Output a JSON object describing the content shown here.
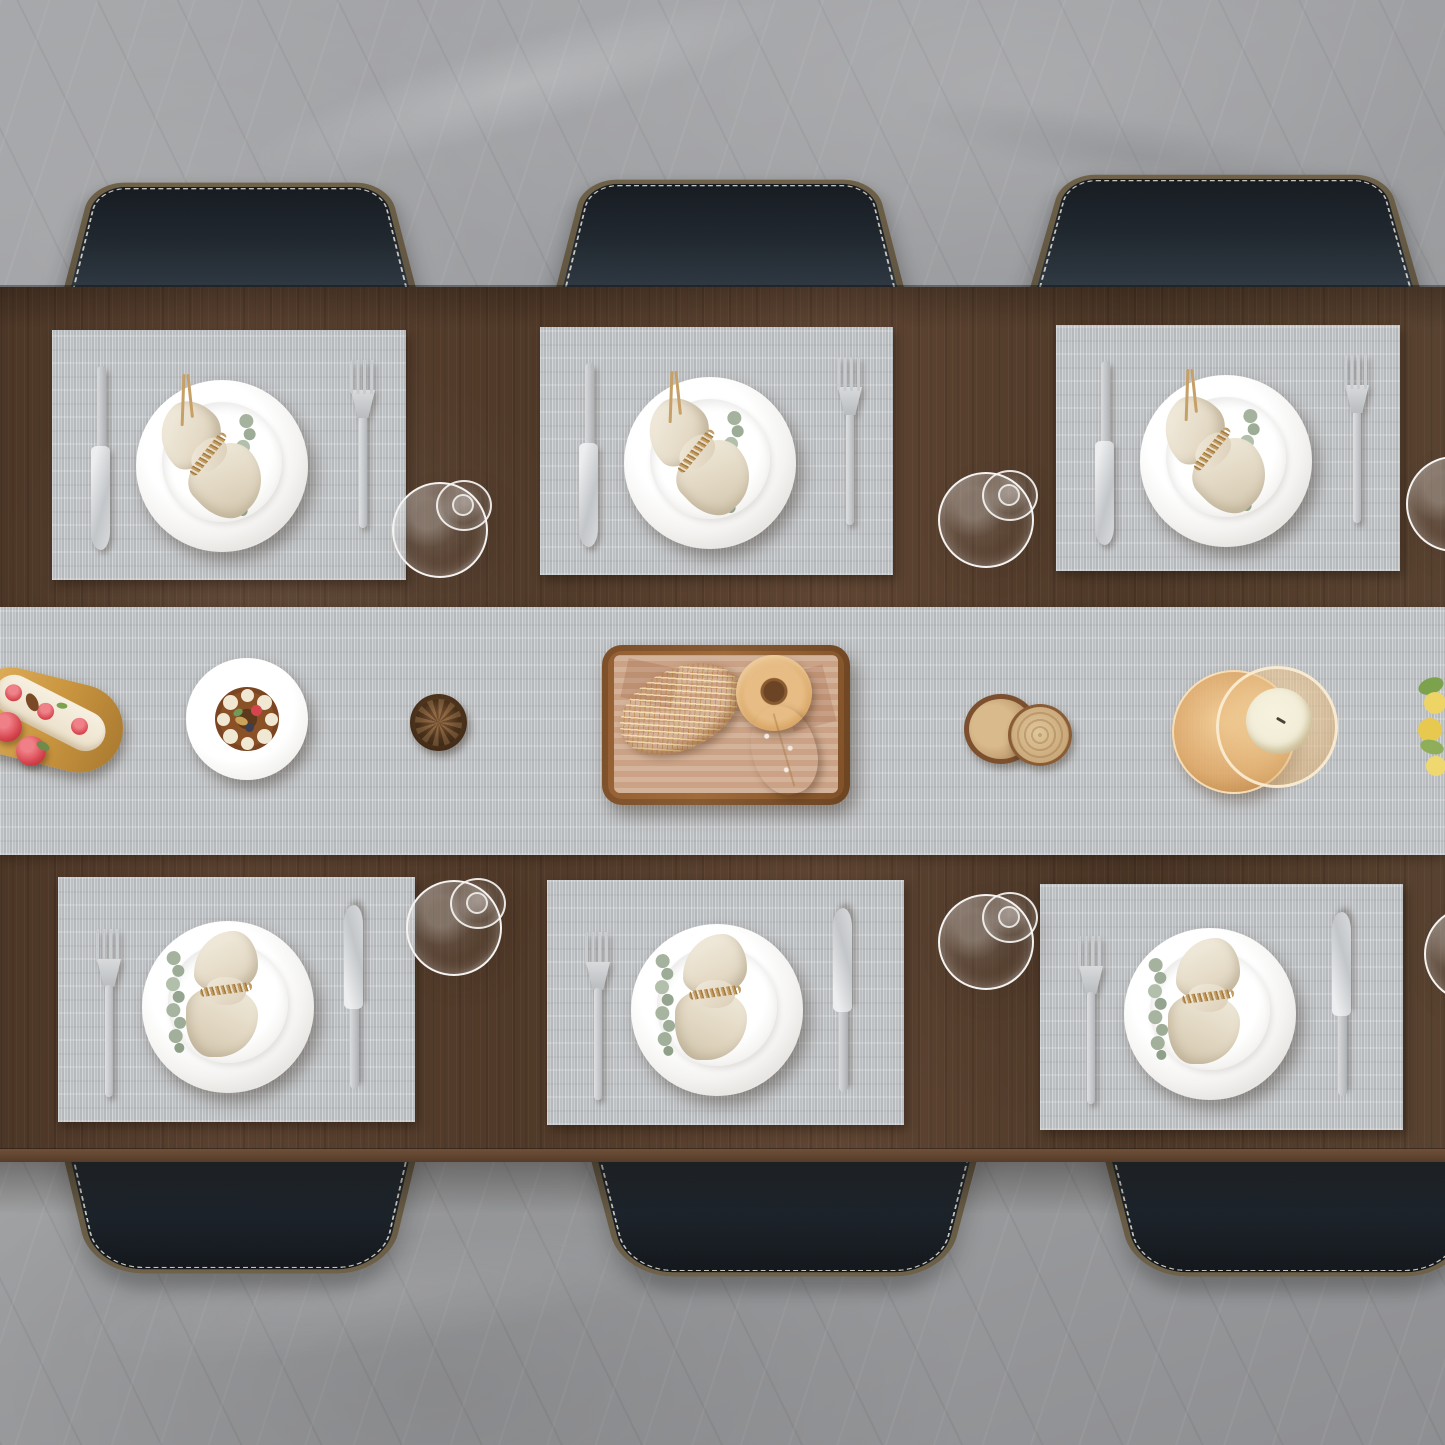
{
  "scene": {
    "type": "product-photo",
    "view": "top-down",
    "description": "Overhead view of a dark walnut dining table set for six on a gray marble floor. Six woven gray placemats and a matching table runner hold white plates with cream napkins tied in twine and eucalyptus sprigs, flanked by silver knives and forks, with six wine glasses lying beside the mats. The runner is decorated with a strawberry eclair on a wooden board, a chocolate dessert plate, a pine cone, a wooden bread tray with sesame bread, a donut and a sugared bun, wood-slice decor, a candle in an amber glass holder and yellow flowers. Six black leather chairs with white zigzag stitching surround the table.",
    "place_settings": 6,
    "chairs_visible": 6,
    "wine_glasses": 6
  },
  "items": {
    "table": "Walnut dining table",
    "runner": "Woven gray table runner",
    "placemat": "Woven gray placemat",
    "chair": "Black leather chair with white stitching",
    "plate": "White dinner plate",
    "salad_plate": "White salad plate",
    "napkin": "Cream linen napkin tied with twine",
    "eucalyptus": "Eucalyptus sprig",
    "knife": "Silver dinner knife",
    "fork": "Silver dinner fork",
    "glass": "Wine glass on its side",
    "bread_tray": "Wooden bread tray with paper liner",
    "sesame_bread": "Sesame-crusted bread",
    "donut": "Donut",
    "bun": "Sugar-dusted bun",
    "eclair": "Strawberry eclair on wooden board",
    "berries": "Red berries",
    "dessert": "Chocolate dessert with cream dollops",
    "pinecone": "Pine cone",
    "logs": "Wood slice decor",
    "candle": "Candle in amber glass holder",
    "flowers": "Yellow flowers"
  },
  "colors": {
    "floor": "#9b9c9f",
    "wood": "#553c2b",
    "wood-light": "#6a4c36",
    "wood-edge": "#6f5038",
    "mat": "#c4c7ca",
    "mat-light": "#d3d6d8",
    "mat-dark": "#b6b9bc",
    "plate-white": "#f7f6f4",
    "napkin": "#ece4d4",
    "twine": "#c59d62",
    "eucalyptus": "#a5b39e",
    "silver": "#c9cccf",
    "chair-leather": "#20262d",
    "chair-rim": "#6f6249",
    "stitch": "#e7e2d6",
    "tray-wood": "#935f33",
    "paper": "#cba285",
    "bread": "#d29542",
    "donut": "#e7bd85",
    "bun": "#ead0a7",
    "cream": "#f1e8d4",
    "berry": "#d6454e",
    "chocolate": "#8a5126",
    "pinecone": "#54381f",
    "log": "#c9a87a",
    "bark": "#7c4f2e",
    "amber": "#dea86c",
    "wax": "#f2edd8",
    "flower": "#eed464",
    "leaf": "#7da24e",
    "glass-line": "#f4f3f1"
  }
}
